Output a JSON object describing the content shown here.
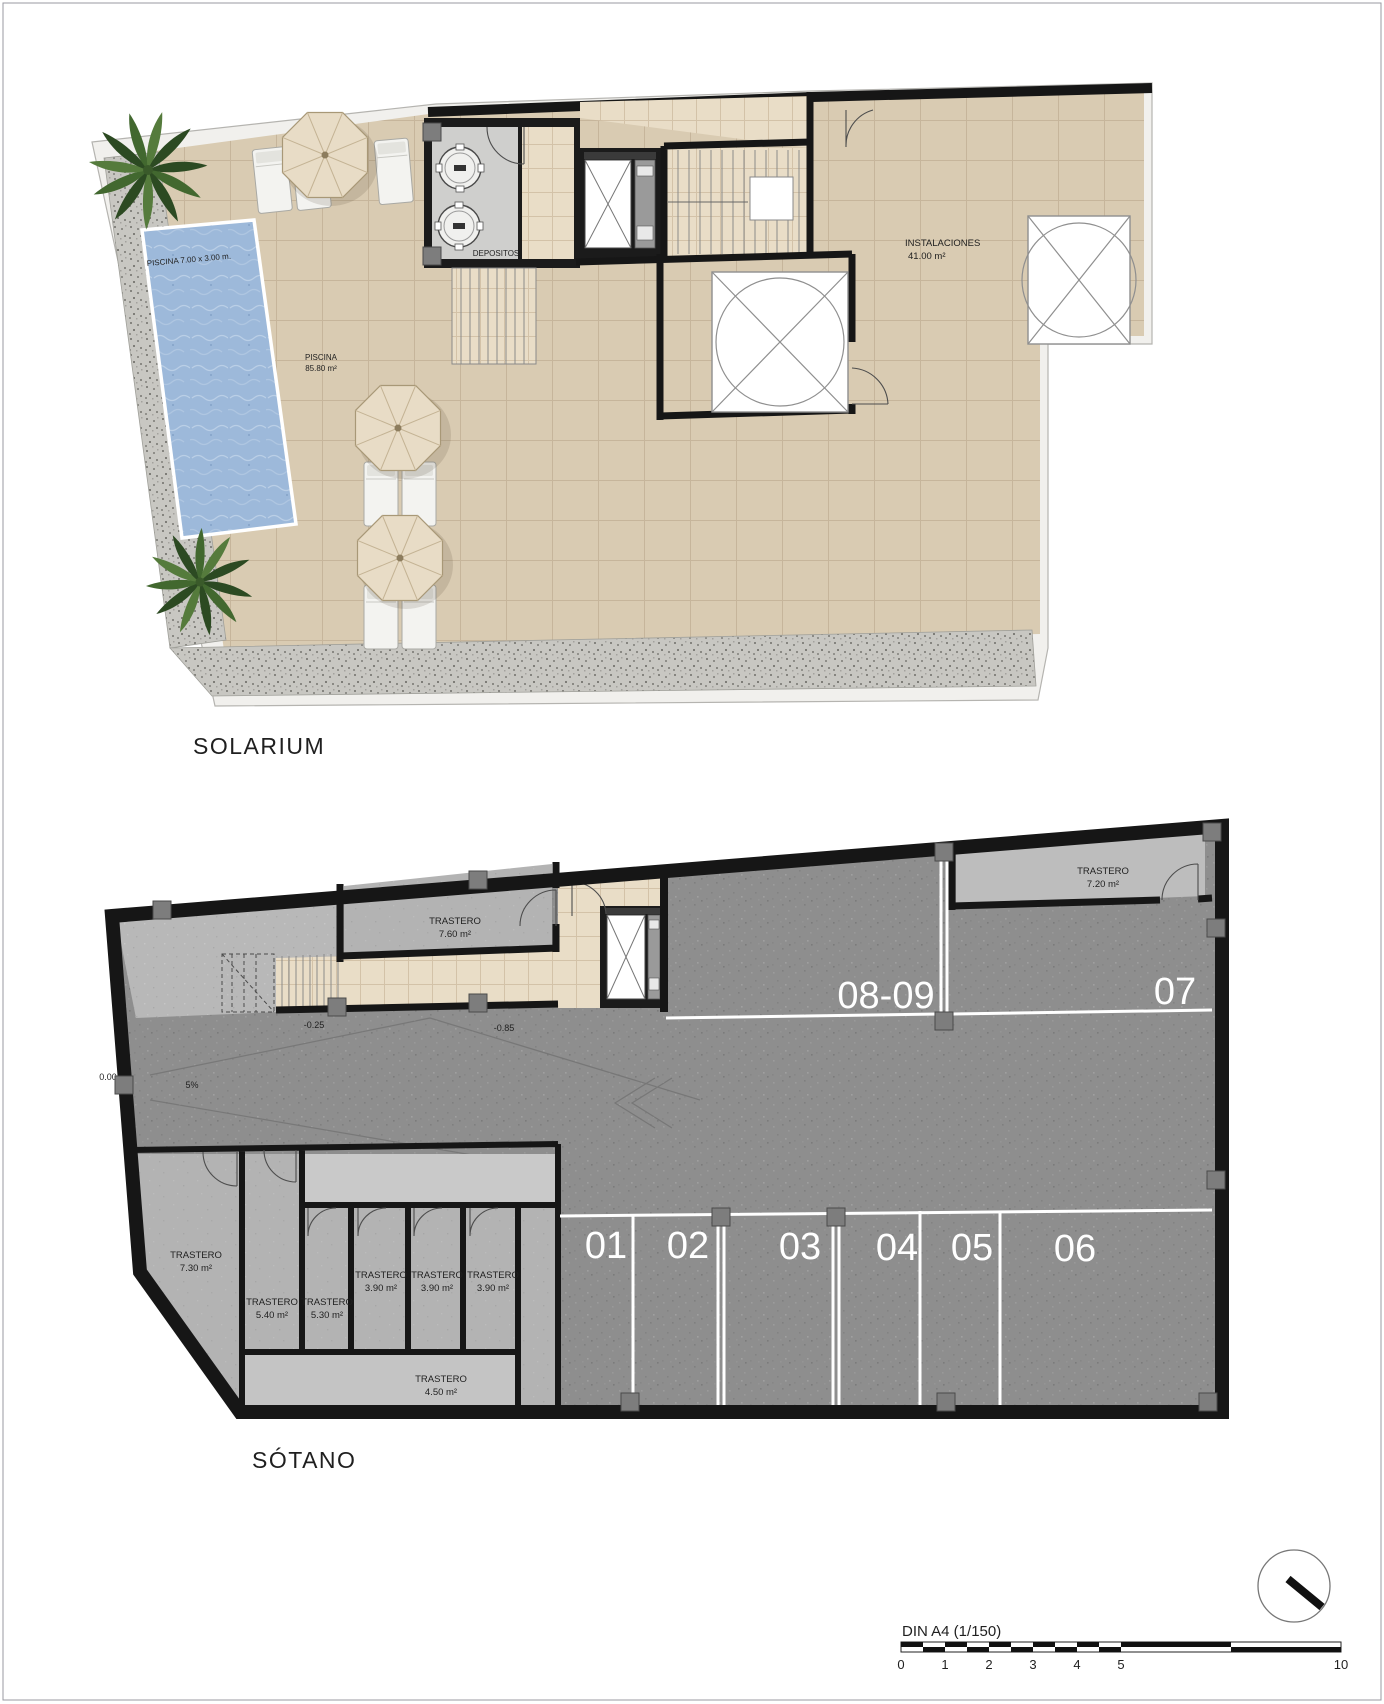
{
  "solarium": {
    "title": "SOLARIUM",
    "pool_dim": "PISCINA 7.00 x 3.00 m.",
    "pool_name": "PISCINA",
    "pool_area": "85.80 m²",
    "depositos": "DEPOSITOS",
    "instalaciones_name": "INSTALACIONES",
    "instalaciones_area": "41.00 m²"
  },
  "sotano": {
    "title": "SÓTANO",
    "levels": {
      "street": "0.00",
      "slope": "5%",
      "mid": "-0.25",
      "low": "-0.85"
    },
    "storerooms": {
      "t760_name": "TRASTERO",
      "t760_area": "7.60 m²",
      "t720_name": "TRASTERO",
      "t720_area": "7.20 m²",
      "t730_name": "TRASTERO",
      "t730_area": "7.30 m²",
      "t540_name": "TRASTERO",
      "t540_area": "5.40 m²",
      "t530_name": "TRASTERO",
      "t530_area": "5.30 m²",
      "t390a_name": "TRASTERO",
      "t390a_area": "3.90 m²",
      "t390b_name": "TRASTERO",
      "t390b_area": "3.90 m²",
      "t390c_name": "TRASTERO",
      "t390c_area": "3.90 m²",
      "t450_name": "TRASTERO",
      "t450_area": "4.50 m²"
    },
    "parking_top": [
      "08-09",
      "07"
    ],
    "parking_bottom": [
      "01",
      "02",
      "03",
      "04",
      "05",
      "06"
    ]
  },
  "footer": {
    "scale_label": "DIN A4 (1/150)",
    "ticks": [
      "0",
      "1",
      "2",
      "3",
      "4",
      "5",
      "10"
    ]
  },
  "palette": {
    "wall": "#161616",
    "terrace_tile": "#d9cbb2",
    "pool_water": "#9db9da",
    "asphalt": "#8e8e8e",
    "concrete": "#b8b8b8",
    "room_gray": "#b3b3b3",
    "gravel": "#c8c7c2",
    "parking_marking": "#ffffff"
  }
}
